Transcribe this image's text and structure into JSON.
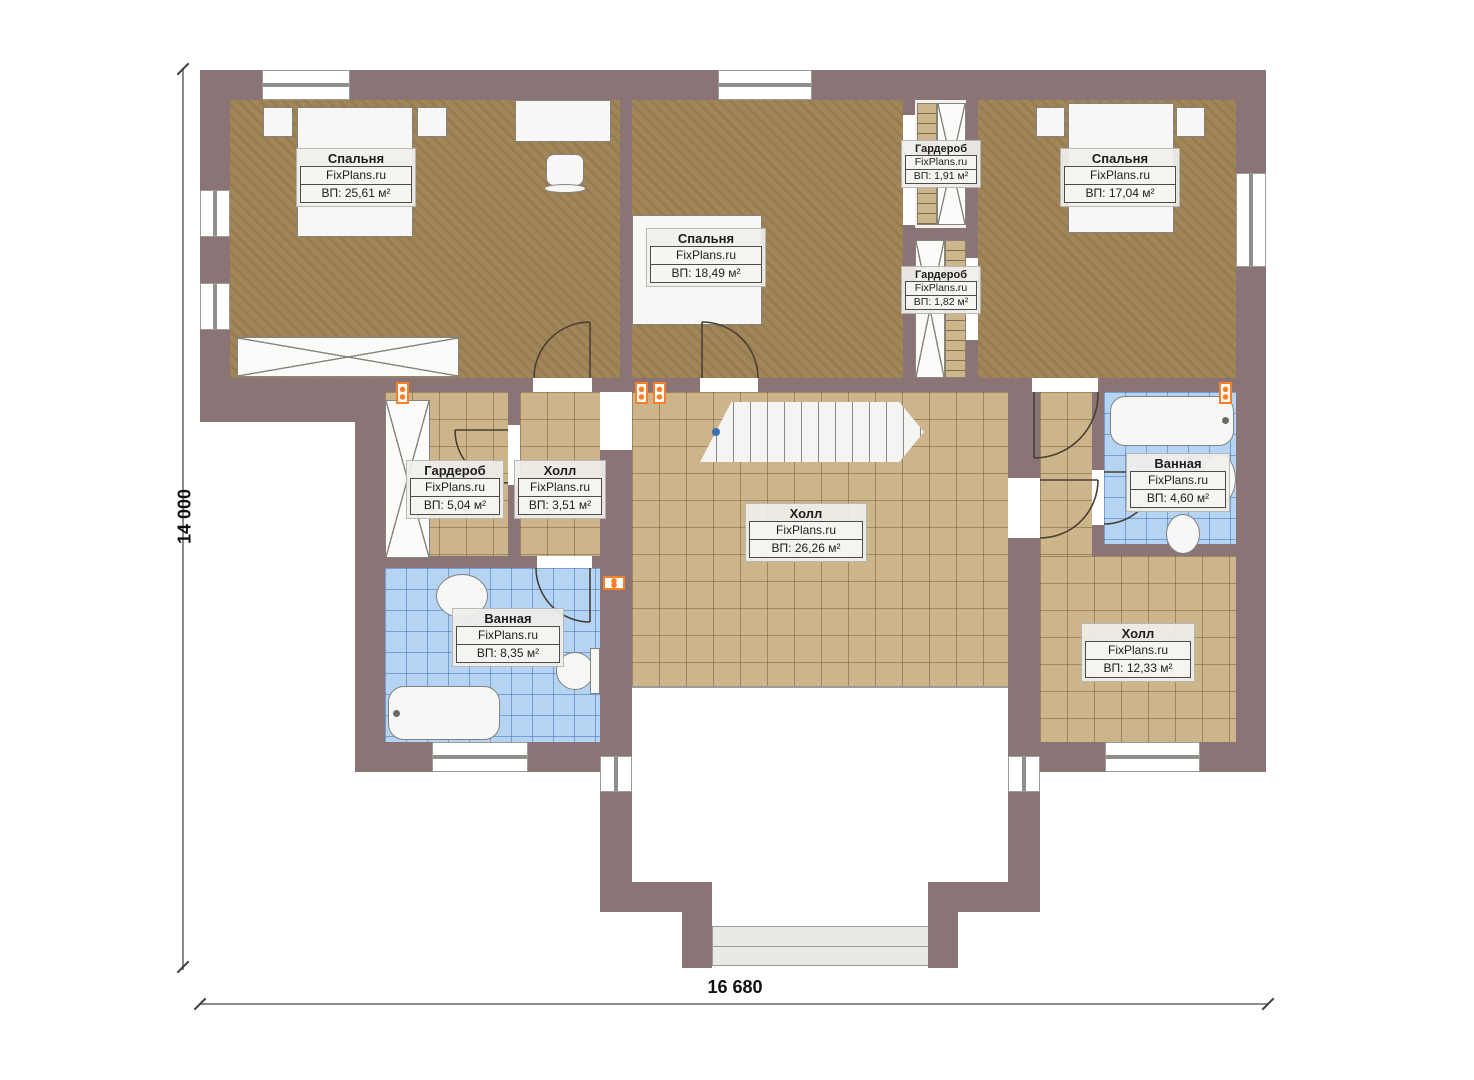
{
  "plan": {
    "brand": "FixPlans.ru",
    "dimensions": {
      "height_label": "14 000",
      "width_label": "16 680"
    },
    "rooms": [
      {
        "id": "bedroom-left",
        "name": "Спальня",
        "area": "ВП: 25,61 м²"
      },
      {
        "id": "bedroom-middle",
        "name": "Спальня",
        "area": "ВП: 18,49 м²"
      },
      {
        "id": "bedroom-right",
        "name": "Спальня",
        "area": "ВП: 17,04 м²"
      },
      {
        "id": "wardrobe-upper",
        "name": "Гардероб",
        "area": "ВП: 1,91 м²"
      },
      {
        "id": "wardrobe-lower",
        "name": "Гардероб",
        "area": "ВП: 1,82 м²"
      },
      {
        "id": "wardrobe-left",
        "name": "Гардероб",
        "area": "ВП: 5,04 м²"
      },
      {
        "id": "hall-small",
        "name": "Холл",
        "area": "ВП: 3,51 м²"
      },
      {
        "id": "hall-main",
        "name": "Холл",
        "area": "ВП: 26,26 м²"
      },
      {
        "id": "bathroom-right",
        "name": "Ванная",
        "area": "ВП: 4,60 м²"
      },
      {
        "id": "bathroom-left",
        "name": "Ванная",
        "area": "ВП: 8,35 м²"
      },
      {
        "id": "hall-right",
        "name": "Холл",
        "area": "ВП: 12,33 м²"
      }
    ],
    "colors": {
      "wall": "#8b7476",
      "bedroom_floor": "#9d8253",
      "tile_floor": "#ccb58a",
      "bath_floor": "#b5d3f2",
      "radiator": "#f97f28"
    }
  }
}
